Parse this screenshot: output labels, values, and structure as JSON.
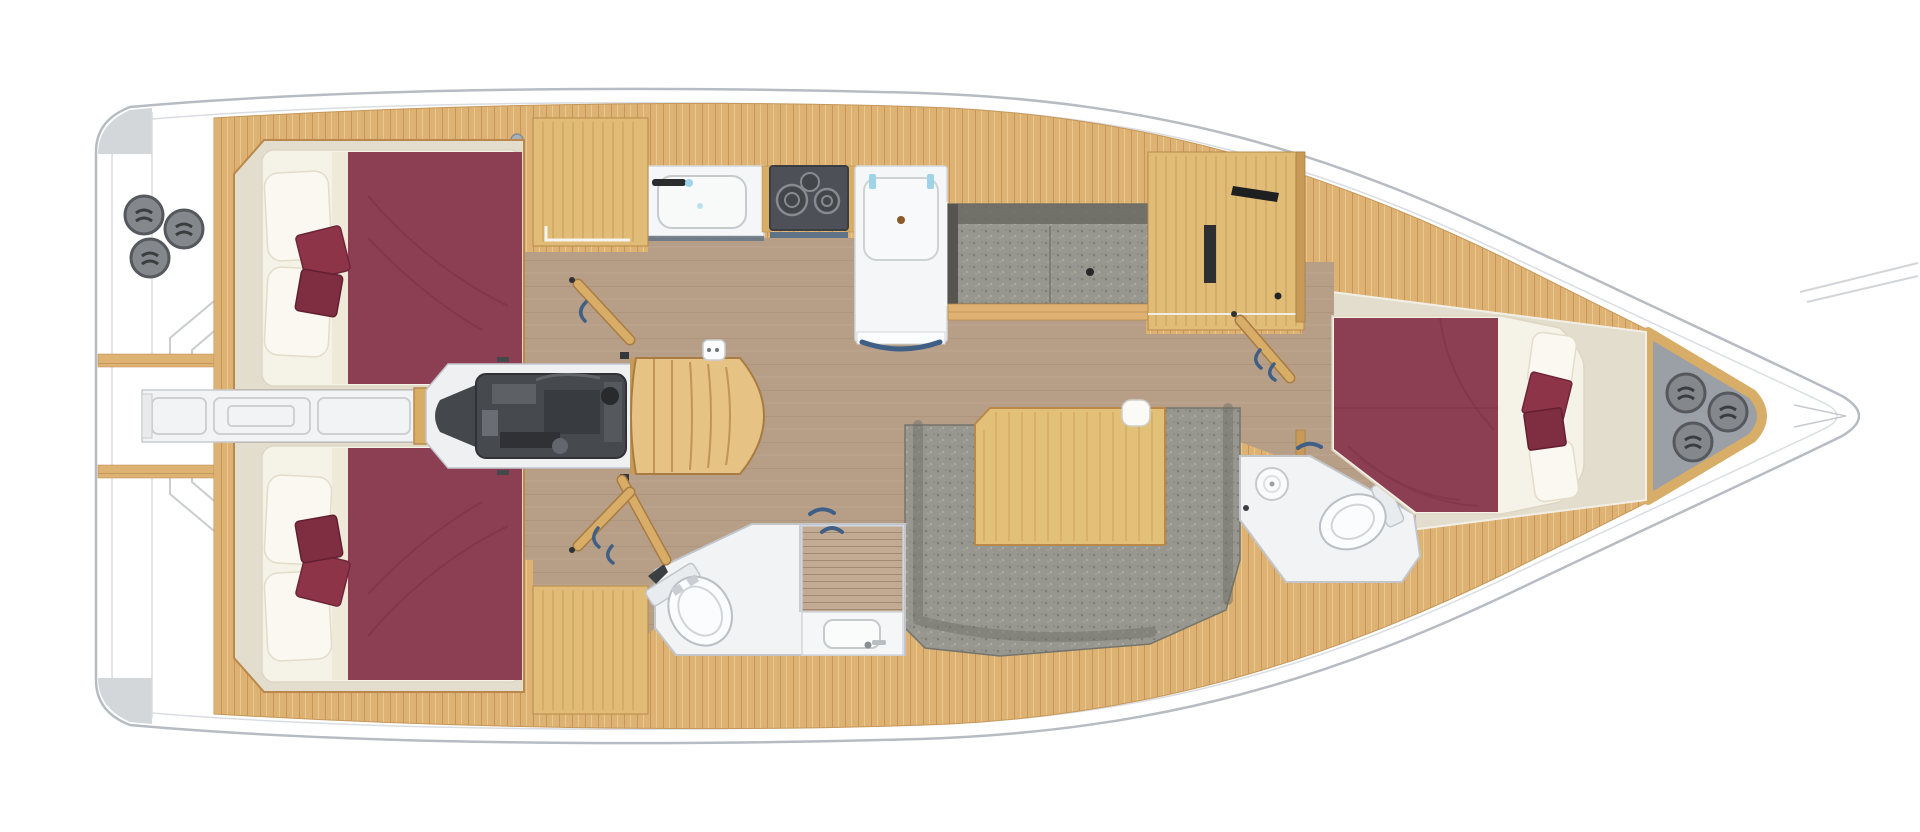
{
  "title": "Sailing yacht interior layout — 3-cabin floor plan, top view",
  "view": "top-down plan, bow to the right, stern to the left, port side on top",
  "counts": {
    "cabins": 3,
    "heads": 2,
    "winch_drums_stern": 3,
    "winch_drums_bow": 3,
    "hob_burners": 2,
    "settees": 2
  },
  "colors": {
    "hull_outline": "#b6bcc2",
    "hull_inner_line": "#d9dde1",
    "teak_deck": "#ddb272",
    "teak_seam": "#c6975a",
    "cabinet_wood": "#e0bc76",
    "cabin_sole": "#b79e87",
    "cabin_floor_cream": "#e2ddcc",
    "mattress_white": "#f5f2e8",
    "pillow_white": "#faf8f0",
    "bedding_maroon": "#8c3e52",
    "accent_cushion": "#8e3448",
    "upholstery_gray": "#98978f",
    "engine_gray": "#46494e",
    "appliance_dark": "#4d5157",
    "fixture_white": "#f1f3f5",
    "bow_pad_gray": "#9aa0a6",
    "winch_gray": "#84878b",
    "handle_blue": "#3f5f86",
    "faucet_cyan": "#9fd4e8",
    "counter_blue": "#5e7288"
  },
  "areas": [
    {
      "id": "hull",
      "label": "White hull — pointed bow right, squared stern left"
    },
    {
      "id": "stern-platform",
      "label": "Stern platform with fold-down transom step outlines"
    },
    {
      "id": "stern-winches",
      "label": "Stern winch cluster — 3 drums"
    },
    {
      "id": "side-decks",
      "label": "Teak side decks and coachroof"
    },
    {
      "id": "aft-cabin-port",
      "label": "Port aft double cabin — berth with maroon bedding, 2 pillows, 2 accent cushions"
    },
    {
      "id": "aft-cabin-starboard",
      "label": "Starboard aft double cabin — berth with maroon bedding, 2 pillows, 2 accent cushions"
    },
    {
      "id": "stern-walkway",
      "label": "Central transom walkway between aft cabins"
    },
    {
      "id": "engine-compartment",
      "label": "Engine compartment under companionway"
    },
    {
      "id": "companionway-steps",
      "label": "Curved companionway steps"
    },
    {
      "id": "galley",
      "label": "Galley — sink, two-burner hob, refrigerator unit"
    },
    {
      "id": "settee-port",
      "label": "Port straight settee"
    },
    {
      "id": "dinette",
      "label": "Starboard dinette — U-shaped settee with wooden table"
    },
    {
      "id": "aft-head",
      "label": "Aft head — WC, teak shower grate, washbasin"
    },
    {
      "id": "forward-head",
      "label": "Forward head — WC and round washbasin"
    },
    {
      "id": "forward-cabin",
      "label": "Forward owner's cabin — island double berth with maroon bedding"
    },
    {
      "id": "bow-locker",
      "label": "Bow locker pad with three drums"
    }
  ]
}
